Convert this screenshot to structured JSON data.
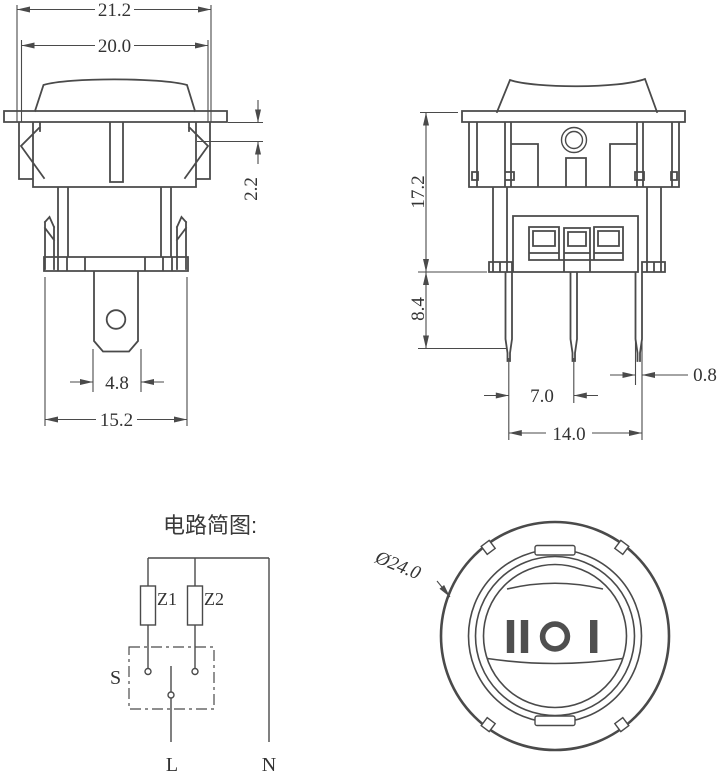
{
  "drawing": {
    "front_view": {
      "width_top": "21.2",
      "width_inner": "20.0",
      "panel_thickness": "2.2",
      "terminal_width": "4.8",
      "body_width": "15.2"
    },
    "side_view": {
      "body_height": "17.2",
      "pin_length": "8.4",
      "pin_pitch": "7.0",
      "pin_span": "14.0",
      "pin_thickness": "0.8"
    },
    "circuit": {
      "heading": "电路简图:",
      "component_z1": "Z1",
      "component_z2": "Z2",
      "switch_label": "S",
      "live_label": "L",
      "neutral_label": "N"
    },
    "face_view": {
      "diameter_label": "Ø24.0",
      "position_markings": "II O I"
    }
  },
  "colors": {
    "line": "#4a4a4a",
    "symbol": "#4f4f4f",
    "text": "#333333",
    "background": "#ffffff"
  }
}
